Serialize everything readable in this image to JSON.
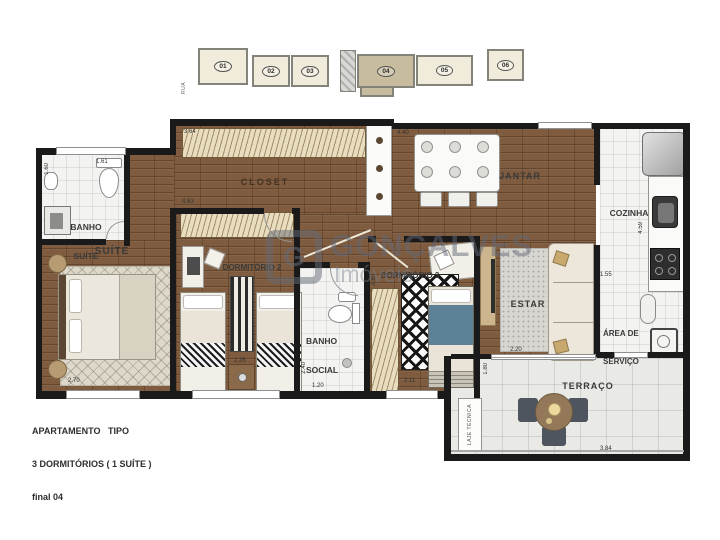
{
  "key_plan": {
    "street_label": "RUA",
    "units": [
      {
        "number": "01",
        "highlighted": false
      },
      {
        "number": "02",
        "highlighted": false
      },
      {
        "number": "03",
        "highlighted": false
      },
      {
        "number": "04",
        "highlighted": true
      },
      {
        "number": "05",
        "highlighted": false
      },
      {
        "number": "06",
        "highlighted": false
      }
    ]
  },
  "watermark": {
    "logo_letter": "G",
    "brand": "GONÇALVES",
    "subtitle": "Imóveis"
  },
  "title_block": {
    "line1": "APARTAMENTO   TIPO",
    "line2": "3 DORMITÓRIOS ( 1 SUÍTE )",
    "line3": "final 04"
  },
  "rooms": {
    "banho_suite": {
      "line1": "BANHO",
      "line2": "SUÍTE"
    },
    "suite": {
      "label": "SUÍTE"
    },
    "closet": {
      "label": "CLOSET"
    },
    "dormitorio2": {
      "label": "DORMITÓRIO 2"
    },
    "dormitorio3": {
      "label": "DORMITÓRIO 3"
    },
    "banho_social": {
      "line1": "BANHO",
      "line2": "SOCIAL"
    },
    "jantar": {
      "label": "JANTAR"
    },
    "estar": {
      "label": "ESTAR"
    },
    "cozinha": {
      "label": "COZINHA"
    },
    "area_servico": {
      "line1": "ÁREA DE",
      "line2": "SERVIÇO"
    },
    "terraco": {
      "label": "TERRAÇO"
    },
    "laje_tecnica": {
      "label": "LAJE TÉCNICA"
    }
  },
  "dimensions": {
    "banho_suite_w": "1.61",
    "banho_suite_h": "1.60",
    "closet_top": "3.64",
    "closet_bottom": "4.63",
    "jantar_w": "4.40",
    "dorm2_w": "2.35",
    "banho_social_v": "2.40",
    "banho_social_h": "1.20",
    "dorm3_v": "2.80",
    "dorm3_h": "2.11",
    "suite_w": "2.70",
    "estar_w": "2.20",
    "terraco_v": "1.80",
    "terraco_h": "3.84",
    "cozinha_v": "4.59",
    "cozinha_h": "1.55"
  },
  "colors": {
    "wall": "#1a1a1a",
    "wood_floor": "#7f5c3f",
    "highlight_unit": "#c8bc9f",
    "blue_bed": "#5d8195"
  }
}
